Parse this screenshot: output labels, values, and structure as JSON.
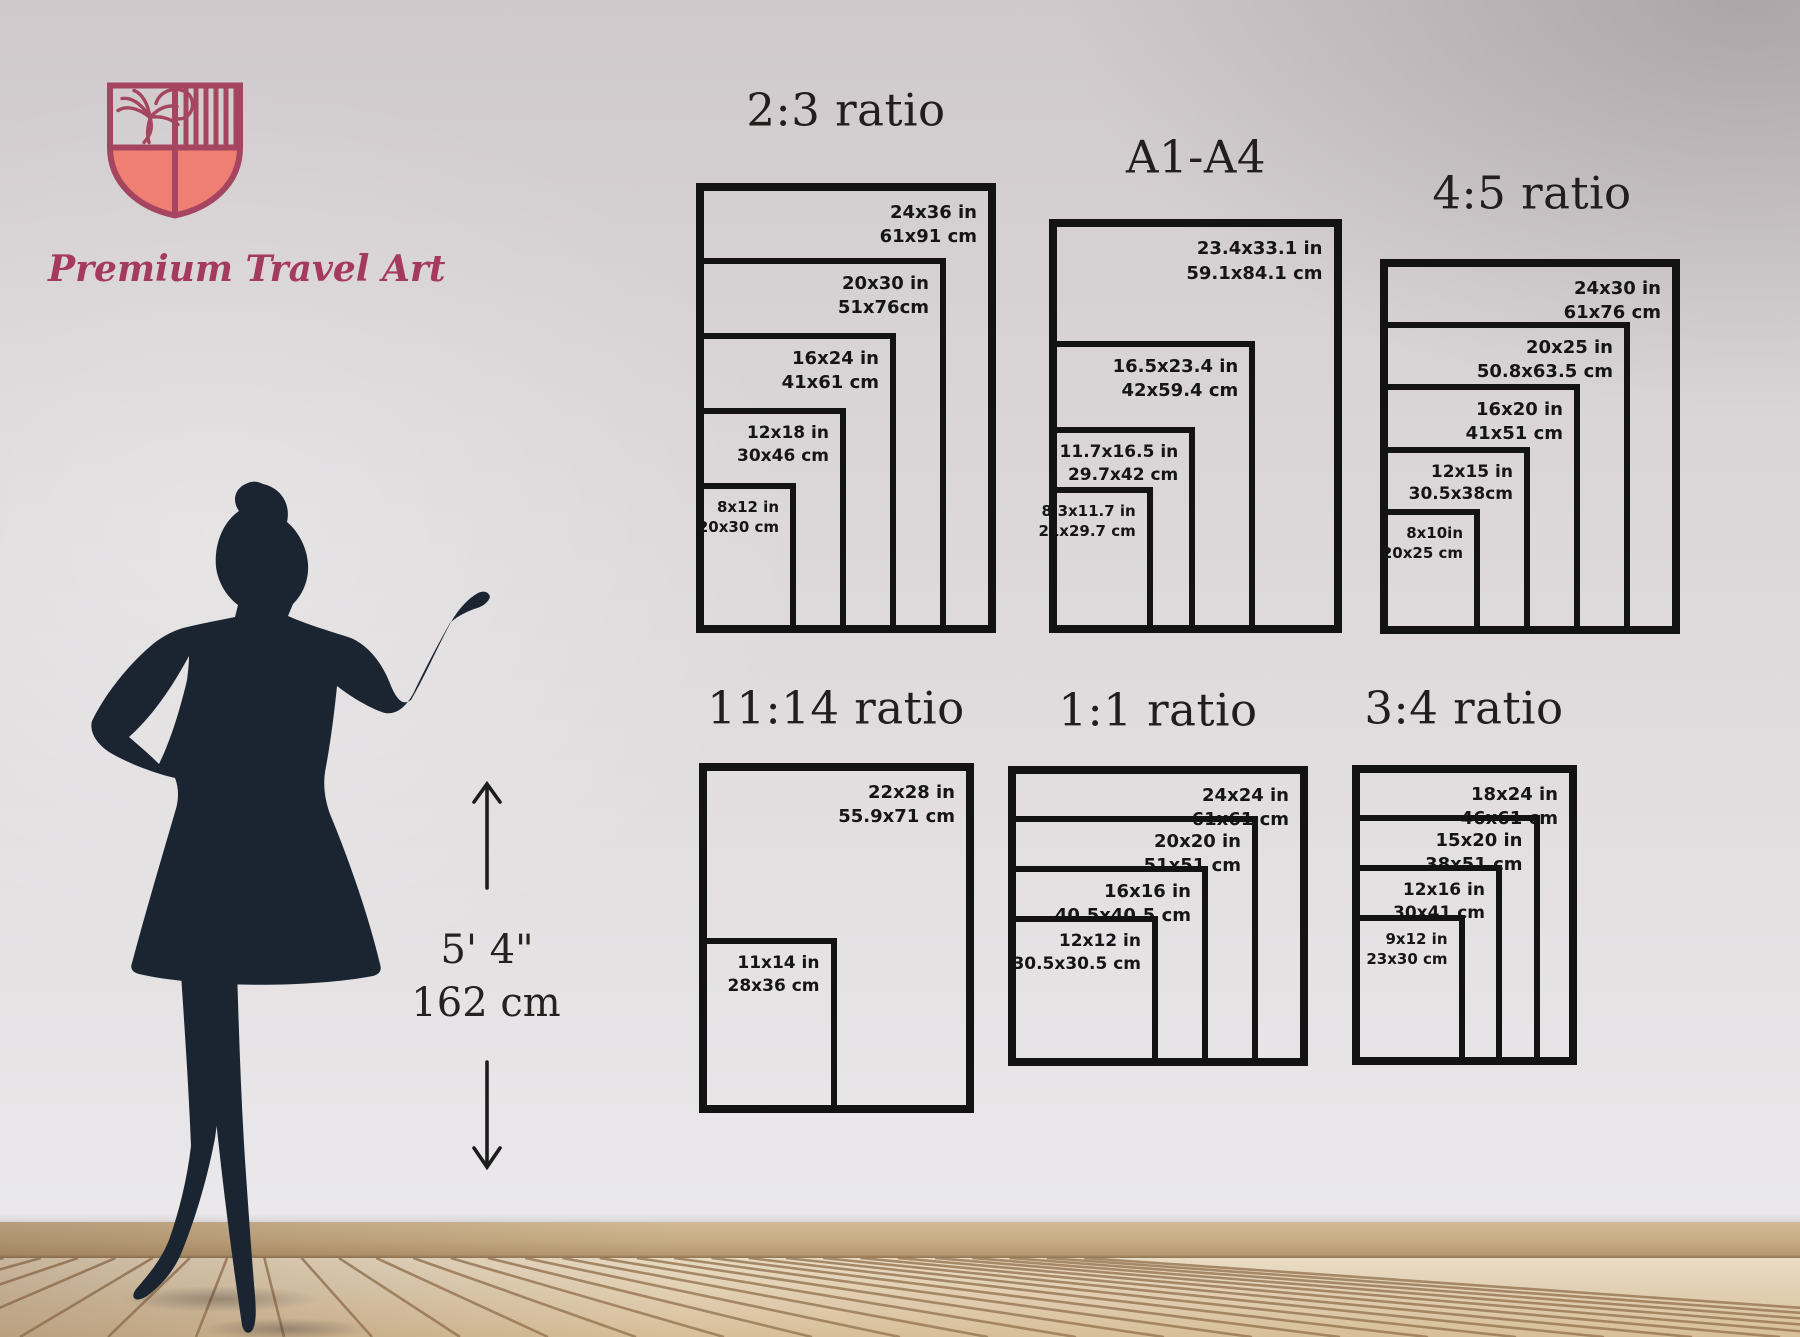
{
  "brand": {
    "logo_text": "Premium Travel Art"
  },
  "scale_figure": {
    "height_imperial": "5' 4\"",
    "height_metric": "162 cm"
  },
  "colors": {
    "accent_crimson": "#a54560",
    "accent_coral": "#ef7f72",
    "chart_line": "#131313",
    "silhouette": "#1b2531",
    "wood_seam": "#9b7b58"
  },
  "charts": [
    {
      "id": "ratio-2-3",
      "title": "2:3 ratio",
      "sizes": [
        {
          "inches": "24x36 in",
          "cm": "61x91 cm",
          "w_in": 24,
          "h_in": 36
        },
        {
          "inches": "20x30 in",
          "cm": "51x76cm",
          "w_in": 20,
          "h_in": 30
        },
        {
          "inches": "16x24 in",
          "cm": "41x61 cm",
          "w_in": 16,
          "h_in": 24
        },
        {
          "inches": "12x18 in",
          "cm": "30x46 cm",
          "w_in": 12,
          "h_in": 18
        },
        {
          "inches": "8x12 in",
          "cm": "20x30 cm",
          "w_in": 8,
          "h_in": 12
        }
      ]
    },
    {
      "id": "a-series",
      "title": "A1-A4",
      "sizes": [
        {
          "inches": "23.4x33.1 in",
          "cm": "59.1x84.1 cm",
          "w_in": 23.4,
          "h_in": 33.1
        },
        {
          "inches": "16.5x23.4 in",
          "cm": "42x59.4 cm",
          "w_in": 16.5,
          "h_in": 23.4
        },
        {
          "inches": "11.7x16.5 in",
          "cm": "29.7x42 cm",
          "w_in": 11.7,
          "h_in": 16.5
        },
        {
          "inches": "8.3x11.7 in",
          "cm": "21x29.7 cm",
          "w_in": 8.3,
          "h_in": 11.7
        }
      ]
    },
    {
      "id": "ratio-4-5",
      "title": "4:5 ratio",
      "sizes": [
        {
          "inches": "24x30 in",
          "cm": "61x76 cm",
          "w_in": 24,
          "h_in": 30
        },
        {
          "inches": "20x25 in",
          "cm": "50.8x63.5 cm",
          "w_in": 20,
          "h_in": 25
        },
        {
          "inches": "16x20 in",
          "cm": "41x51 cm",
          "w_in": 16,
          "h_in": 20
        },
        {
          "inches": "12x15 in",
          "cm": "30.5x38cm",
          "w_in": 12,
          "h_in": 15
        },
        {
          "inches": "8x10in",
          "cm": "20x25 cm",
          "w_in": 8,
          "h_in": 10
        }
      ]
    },
    {
      "id": "ratio-11-14",
      "title": "11:14 ratio",
      "sizes": [
        {
          "inches": "22x28 in",
          "cm": "55.9x71 cm",
          "w_in": 22,
          "h_in": 28
        },
        {
          "inches": "11x14 in",
          "cm": "28x36 cm",
          "w_in": 11,
          "h_in": 14
        }
      ]
    },
    {
      "id": "ratio-1-1",
      "title": "1:1 ratio",
      "sizes": [
        {
          "inches": "24x24 in",
          "cm": "61x61 cm",
          "w_in": 24,
          "h_in": 24
        },
        {
          "inches": "20x20 in",
          "cm": "51x51 cm",
          "w_in": 20,
          "h_in": 20
        },
        {
          "inches": "16x16 in",
          "cm": "40.5x40.5 cm",
          "w_in": 16,
          "h_in": 16
        },
        {
          "inches": "12x12 in",
          "cm": "30.5x30.5 cm",
          "w_in": 12,
          "h_in": 12
        }
      ]
    },
    {
      "id": "ratio-3-4",
      "title": "3:4 ratio",
      "sizes": [
        {
          "inches": "18x24 in",
          "cm": "46x61 cm",
          "w_in": 18,
          "h_in": 24
        },
        {
          "inches": "15x20 in",
          "cm": "38x51 cm",
          "w_in": 15,
          "h_in": 20
        },
        {
          "inches": "12x16 in",
          "cm": "30x41 cm",
          "w_in": 12,
          "h_in": 16
        },
        {
          "inches": "9x12 in",
          "cm": "23x30 cm",
          "w_in": 9,
          "h_in": 12
        }
      ]
    }
  ]
}
